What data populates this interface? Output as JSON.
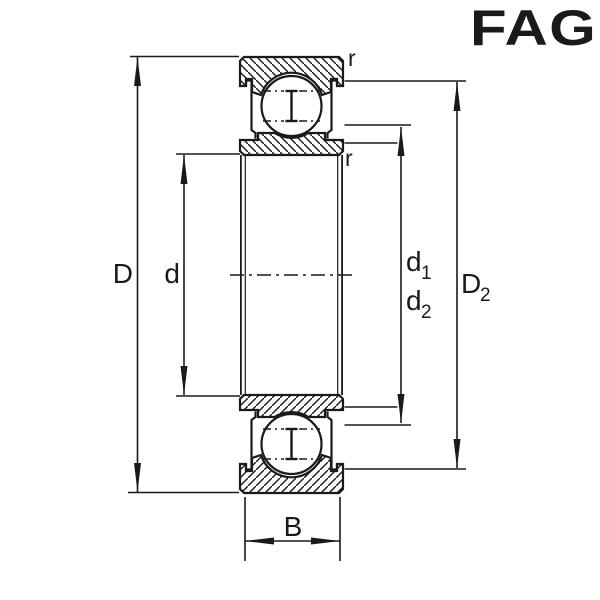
{
  "logo": {
    "text": "FAG",
    "color": "#e2001a"
  },
  "drawing": {
    "type": "bearing-cross-section",
    "line_color": "#1a1a1a",
    "background": "#ffffff",
    "dimensions": {
      "outer_diameter": {
        "main": "D",
        "sub": ""
      },
      "bore_diameter": {
        "main": "d",
        "sub": ""
      },
      "d1": {
        "main": "d",
        "sub": "1"
      },
      "d2": {
        "main": "d",
        "sub": "2"
      },
      "D2": {
        "main": "D",
        "sub": "2"
      },
      "width": {
        "main": "B",
        "sub": ""
      },
      "fillet_radius_top": "r",
      "fillet_radius_bottom": "r"
    }
  }
}
